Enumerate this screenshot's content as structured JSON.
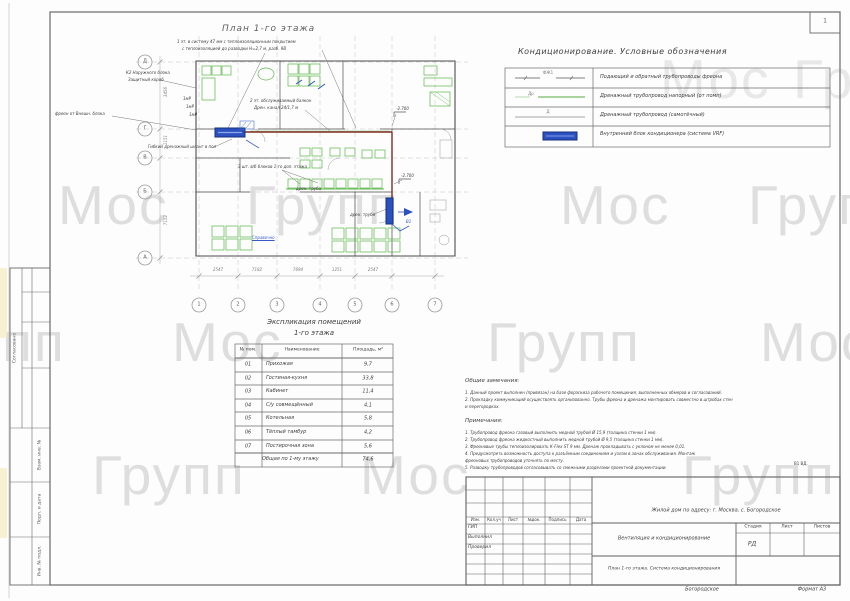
{
  "page": {
    "corner_mark": "1",
    "watermark_words": [
      "Мос",
      "Групп",
      "Мос",
      "Групп",
      "Мос",
      "Групп",
      "Групп",
      "Мос",
      "Групп",
      "Мос",
      "Групп",
      "Мос",
      "Групп"
    ],
    "format_note": "Формат А3",
    "location_note": "Богородское"
  },
  "side_stamp": {
    "labels": [
      "Согласовано",
      "Взам. инв. №",
      "Подп. и дата",
      "Инв. № подл."
    ]
  },
  "plan": {
    "title": "План 1-го этажа",
    "grid_columns": [
      "1",
      "2",
      "3",
      "4",
      "5",
      "6",
      "7"
    ],
    "grid_rows": [
      "Д",
      "Г",
      "В",
      "Б",
      "А"
    ],
    "dims_bottom": [
      "2547",
      "7182",
      "7694",
      "1251",
      "2547"
    ],
    "dims_left": [
      "3456",
      "1151",
      "7152"
    ],
    "annotations": [
      "1 эт. в систему 47 мм с теплоизоляционным покрытием",
      "с теплоизоляцией до разводки Н=2,7 м, разб. 9В",
      "К2 Наружного блока",
      "Защитный короб",
      "фреон от Внешн. блока",
      "Гибкий дренажный шланг в пол",
      "2 эт. обслуживаемый балкон",
      "Дрен. канал 24/1,7 м",
      "3 шт. в/б блоков 1-го доп. этажа",
      "дрен. труба",
      "дрен. труба",
      "-2.700",
      "-2.700",
      "В1",
      "Справочно",
      "1мР",
      "1мР",
      "1мР"
    ]
  },
  "legend": {
    "title": "Кондиционирование.  Условные обозначения",
    "symbol_labels": [
      "ФЖ1",
      "Др",
      "Д"
    ],
    "rows": [
      "Подающий и обратный трубопроводы фреона",
      "Дренажный трубопровод напорный (от помп)",
      "Дренажный трубопровод (самотёчный)",
      "Внутренний блок кондиционера (система VRF)"
    ]
  },
  "explication": {
    "title_line1": "Экспликация помещений",
    "title_line2": "1-го этажа",
    "headers": [
      "№ пом.",
      "Наименование",
      "Площадь, м²"
    ],
    "rows": [
      {
        "num": "01",
        "name": "Прихожая",
        "area": "9,7"
      },
      {
        "num": "02",
        "name": "Гостиная-кухня",
        "area": "33,8"
      },
      {
        "num": "03",
        "name": "Кабинет",
        "area": "11,4"
      },
      {
        "num": "04",
        "name": "С/у совмещённый",
        "area": "4,1"
      },
      {
        "num": "05",
        "name": "Котельная",
        "area": "5,8"
      },
      {
        "num": "06",
        "name": "Тёплый тамбур",
        "area": "4,2"
      },
      {
        "num": "07",
        "name": "Постирочная зона",
        "area": "5,6"
      }
    ],
    "total_label": "Общая по 1-му этажу",
    "total_area": "74,6"
  },
  "notes": {
    "general_title": "Общие замечания:",
    "general_lines": [
      "1.  Данный проект выполнен (привязан) на базе форэскиза рабочего помещения,  выполненных обмеров и согласований.",
      "2.  Прокладку коммуникаций осуществлять организованно.  Трубы фреона и дренажа монтировать совместно в штробах стен",
      "      и перегородках."
    ],
    "notes_title": "Примечания:",
    "notes_lines": [
      "1.  Трубопровод фреона газовый выполнить медной трубой  Ø 15,9  (толщина стенки 1 мм).",
      "2.  Трубопровод фреона жидкостный выполнить медной трубой  Ø 9,5  (толщина стенки 1 мм).",
      "3.  Фреоновые трубы теплоизолировать  К-Flex ST 9 мм.  Дренаж прокладывать с уклоном не менее 0,01.",
      "4.  Предусмотреть возможность доступа к разъёмным соединениям и узлам в зонах обслуживания.  Монтаж",
      "      фреоновых трубопроводов уточнять по месту.",
      "5.  Разводку трубопроводов согласовывать со смежными разделами проектной документации."
    ],
    "side_mark": "В1 ВД."
  },
  "title_block": {
    "project": "Жилой дом по адресу: г. Москва, с. Богородское",
    "section": "Вентиляция и кондиционирование",
    "sheet_name": "План 1-го этажа. Система кондиционирования",
    "columns": [
      "Изм.",
      "Кол.уч",
      "Лист",
      "№док.",
      "Подпись",
      "Дата"
    ],
    "roles": [
      "ГИП",
      "Выполнил",
      "Проверил"
    ],
    "stage_headers": [
      "Стадия",
      "Лист",
      "Листов"
    ],
    "stage_value": "РД"
  },
  "colors": {
    "green": "#5cb54a",
    "blue_unit": "#2b50c0",
    "freon_pipe": "#7e2b24",
    "watermark": "#dedede"
  }
}
